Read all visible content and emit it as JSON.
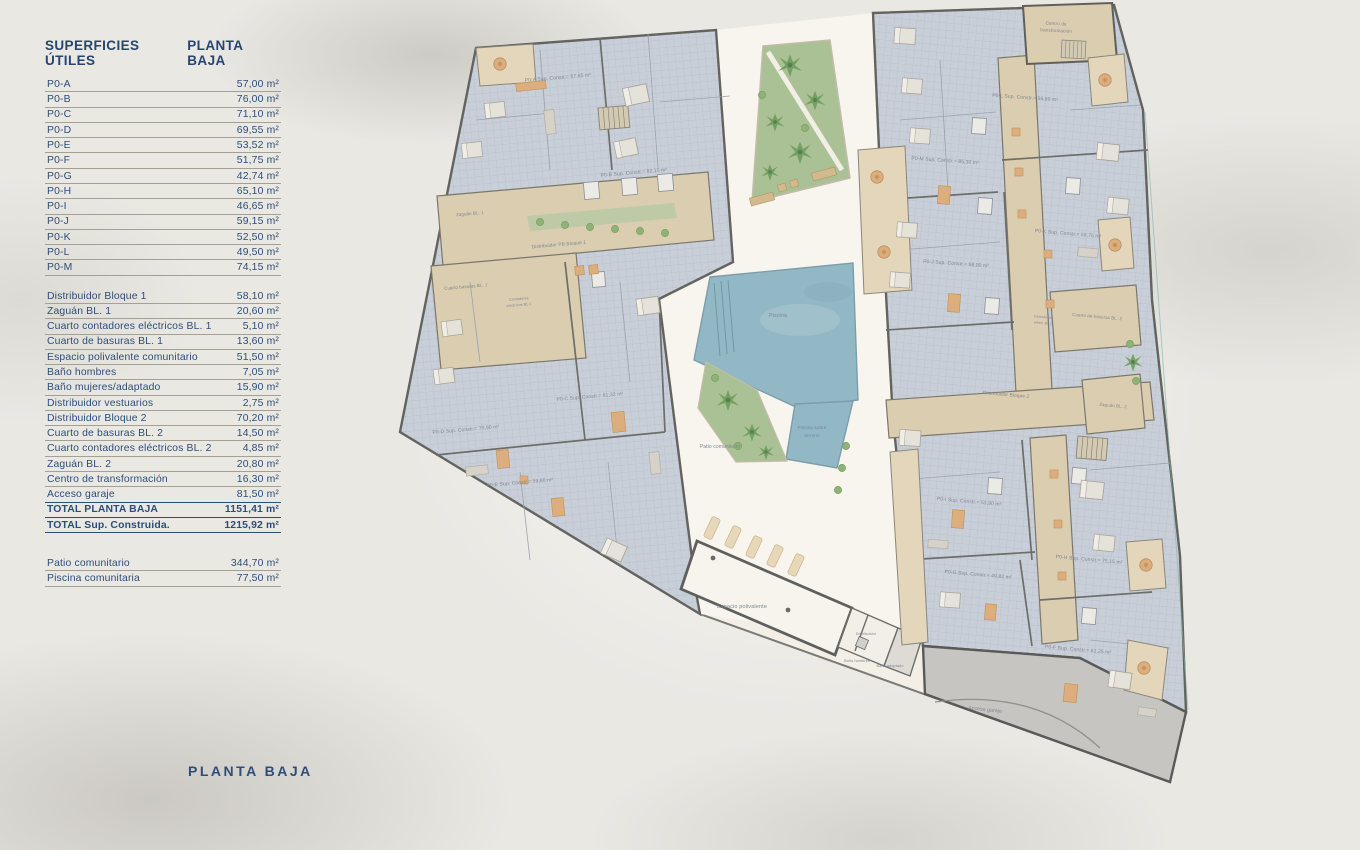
{
  "table": {
    "title_left": "SUPERFICIES ÚTILES",
    "title_right": "PLANTA BAJA",
    "sections": [
      {
        "name": "apartments",
        "rows": [
          {
            "label": "P0-A",
            "value": "57,00 m²"
          },
          {
            "label": "P0-B",
            "value": "76,00 m²"
          },
          {
            "label": "P0-C",
            "value": "71,10 m²"
          },
          {
            "label": "P0-D",
            "value": "69,55 m²"
          },
          {
            "label": "P0-E",
            "value": "53,52 m²"
          },
          {
            "label": "P0-F",
            "value": "51,75 m²"
          },
          {
            "label": "P0-G",
            "value": "42,74 m²"
          },
          {
            "label": "P0-H",
            "value": "65,10 m²"
          },
          {
            "label": "P0-I",
            "value": "46,65 m²"
          },
          {
            "label": "P0-J",
            "value": "59,15 m²"
          },
          {
            "label": "P0-K",
            "value": "52,50 m²"
          },
          {
            "label": "P0-L",
            "value": "49,50 m²"
          },
          {
            "label": "P0-M",
            "value": "74,15 m²"
          }
        ]
      },
      {
        "name": "common",
        "rows": [
          {
            "label": "Distribuidor Bloque 1",
            "value": "58,10 m²"
          },
          {
            "label": "Zaguán BL. 1",
            "value": "20,60 m²"
          },
          {
            "label": "Cuarto contadores eléctricos BL. 1",
            "value": "5,10 m²"
          },
          {
            "label": "Cuarto de basuras BL. 1",
            "value": "13,60 m²"
          },
          {
            "label": "Espacio polivalente comunitario",
            "value": "51,50 m²"
          },
          {
            "label": "Baño hombres",
            "value": "7,05 m²"
          },
          {
            "label": "Baño mujeres/adaptado",
            "value": "15,90 m²"
          },
          {
            "label": "Distribuidor vestuarios",
            "value": "2,75 m²"
          },
          {
            "label": "Distribuidor Bloque 2",
            "value": "70,20 m²"
          },
          {
            "label": "Cuarto de basuras BL. 2",
            "value": "14,50 m²"
          },
          {
            "label": "Cuarto contadores eléctricos BL. 2",
            "value": "4,85 m²"
          },
          {
            "label": "Zaguán BL. 2",
            "value": "20,80 m²"
          },
          {
            "label": "Centro de transformación",
            "value": "16,30 m²"
          },
          {
            "label": "Acceso garaje",
            "value": "81,50 m²"
          },
          {
            "label": "TOTAL PLANTA BAJA",
            "value": "1151,41 m²",
            "total": true
          },
          {
            "label": "TOTAL Sup. Construida.",
            "value": "1215,92 m²",
            "total": true
          }
        ]
      },
      {
        "name": "outdoor",
        "rows": [
          {
            "label": "Patio comunitario",
            "value": "344,70 m²"
          },
          {
            "label": "Piscina comunitaria",
            "value": "77,50 m²"
          }
        ]
      }
    ]
  },
  "page": {
    "footer_label": "PLANTA BAJA"
  },
  "plan": {
    "labels": {
      "pa": "P0-A Sup. Constr.= 67,65 m²",
      "pb": "P0-B Sup. Constr.= 82,15 m²",
      "pc": "P0-C Sup. Constr.= 81,32 m²",
      "pd": "P0-D Sup. Constr.= 70,90 m²",
      "pe": "P0-E Sup. Constr.= 59,80 m²",
      "pf": "P0-F Sup. Constr.= 61,25 m²",
      "pg": "P0-G Sup. Constr.= 49,82 m²",
      "ph": "P0-H Sup. Constr.= 75,15 m²",
      "pi": "P0-I Sup. Constr.= 53,90 m²",
      "pj": "P0-J Sup. Constr.= 68,00 m²",
      "pk": "P0-K Sup. Constr.= 59,75 m²",
      "pl": "P0-L Sup. Constr.= 55,99 m²",
      "pm": "P0-M Sup. Constr.= 85,30 m²",
      "zaguan1": "Zaguán BL. 1",
      "dist1": "Distribuidor PB Bloque 1",
      "basuras1": "Cuarto basuras BL. 1",
      "cont1a": "Contadores",
      "cont1b": "eléctricos BL.1",
      "dist2": "Distribuidor Bloque 2",
      "zaguan2": "Zaguán BL. 2",
      "basuras2": "Cuarto de basuras BL. 2",
      "cont2a": "Contadores",
      "cont2b": "eléctr. BL.2",
      "centro1": "Centro de",
      "centro2": "transformación",
      "piscina": "Piscina",
      "piscina2a": "Piscina sobre",
      "piscina2b": "terreno",
      "patio": "Patio comunitario",
      "espacio": "Espacio polivalente",
      "distS": "Distribuidor",
      "banoH": "Baño hombres",
      "banoA": "Baño adaptado",
      "garaje": "Acceso garaje"
    }
  },
  "colors": {
    "navy": "#2d4e79",
    "wall": "#6d6d6a",
    "block_floor": "#c9cfd8",
    "corridor": "#dbcdb0",
    "terrace": "#e4d6ba",
    "pool": "#92b7c5",
    "green": "#a9c194",
    "garage": "#c6c5c1",
    "site_cream": "#f3efe7",
    "courtyard": "#f8f5ee",
    "furniture": "#dcae7e"
  }
}
